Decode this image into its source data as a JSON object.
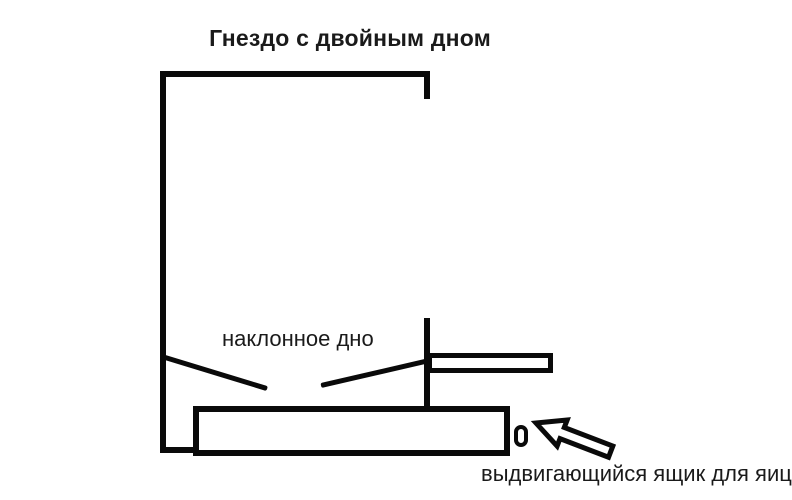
{
  "diagram": {
    "title": "Гнездо с двойным дном",
    "labels": {
      "inclined_bottom": "наклонное дно",
      "egg_drawer": "выдвигающийся ящик для яиц"
    },
    "icons": {
      "arrow": "arrow-icon"
    },
    "colors": {
      "line": "#0a0a0a",
      "text": "#1a1a1a",
      "background": "#ffffff"
    }
  }
}
